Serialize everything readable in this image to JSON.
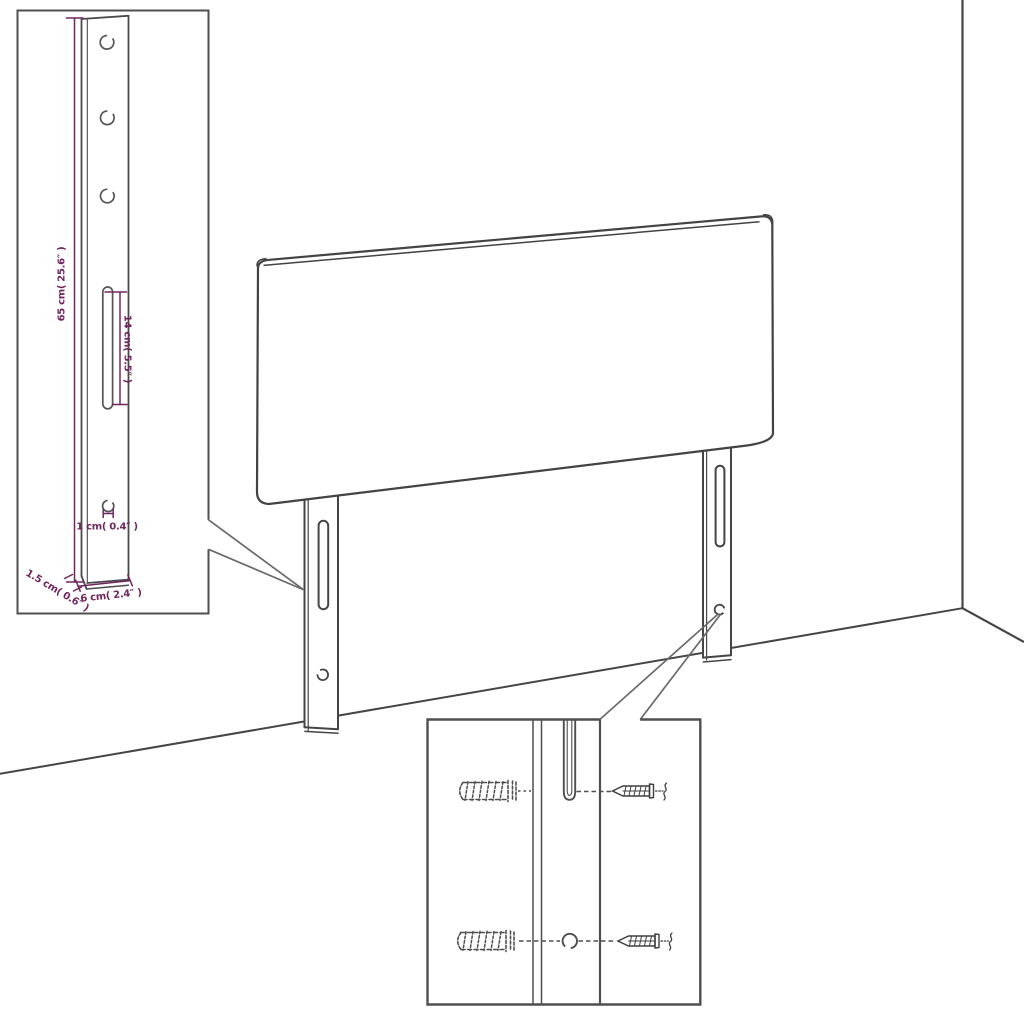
{
  "colors": {
    "background": "#ffffff",
    "line": "#454545",
    "callout": "#6a6a6a",
    "dimension_text": "#71265f"
  },
  "leg_detail_inset": {
    "labels": {
      "leg_height": "65 cm( 25.6″ )",
      "slot_length": "14 cm( 5.5″ )",
      "hole_diameter": "1 cm( 0.4″ )",
      "leg_thickness": "1.5 cm( 0.6″ )",
      "leg_width": "6 cm( 2.4″ )"
    }
  }
}
